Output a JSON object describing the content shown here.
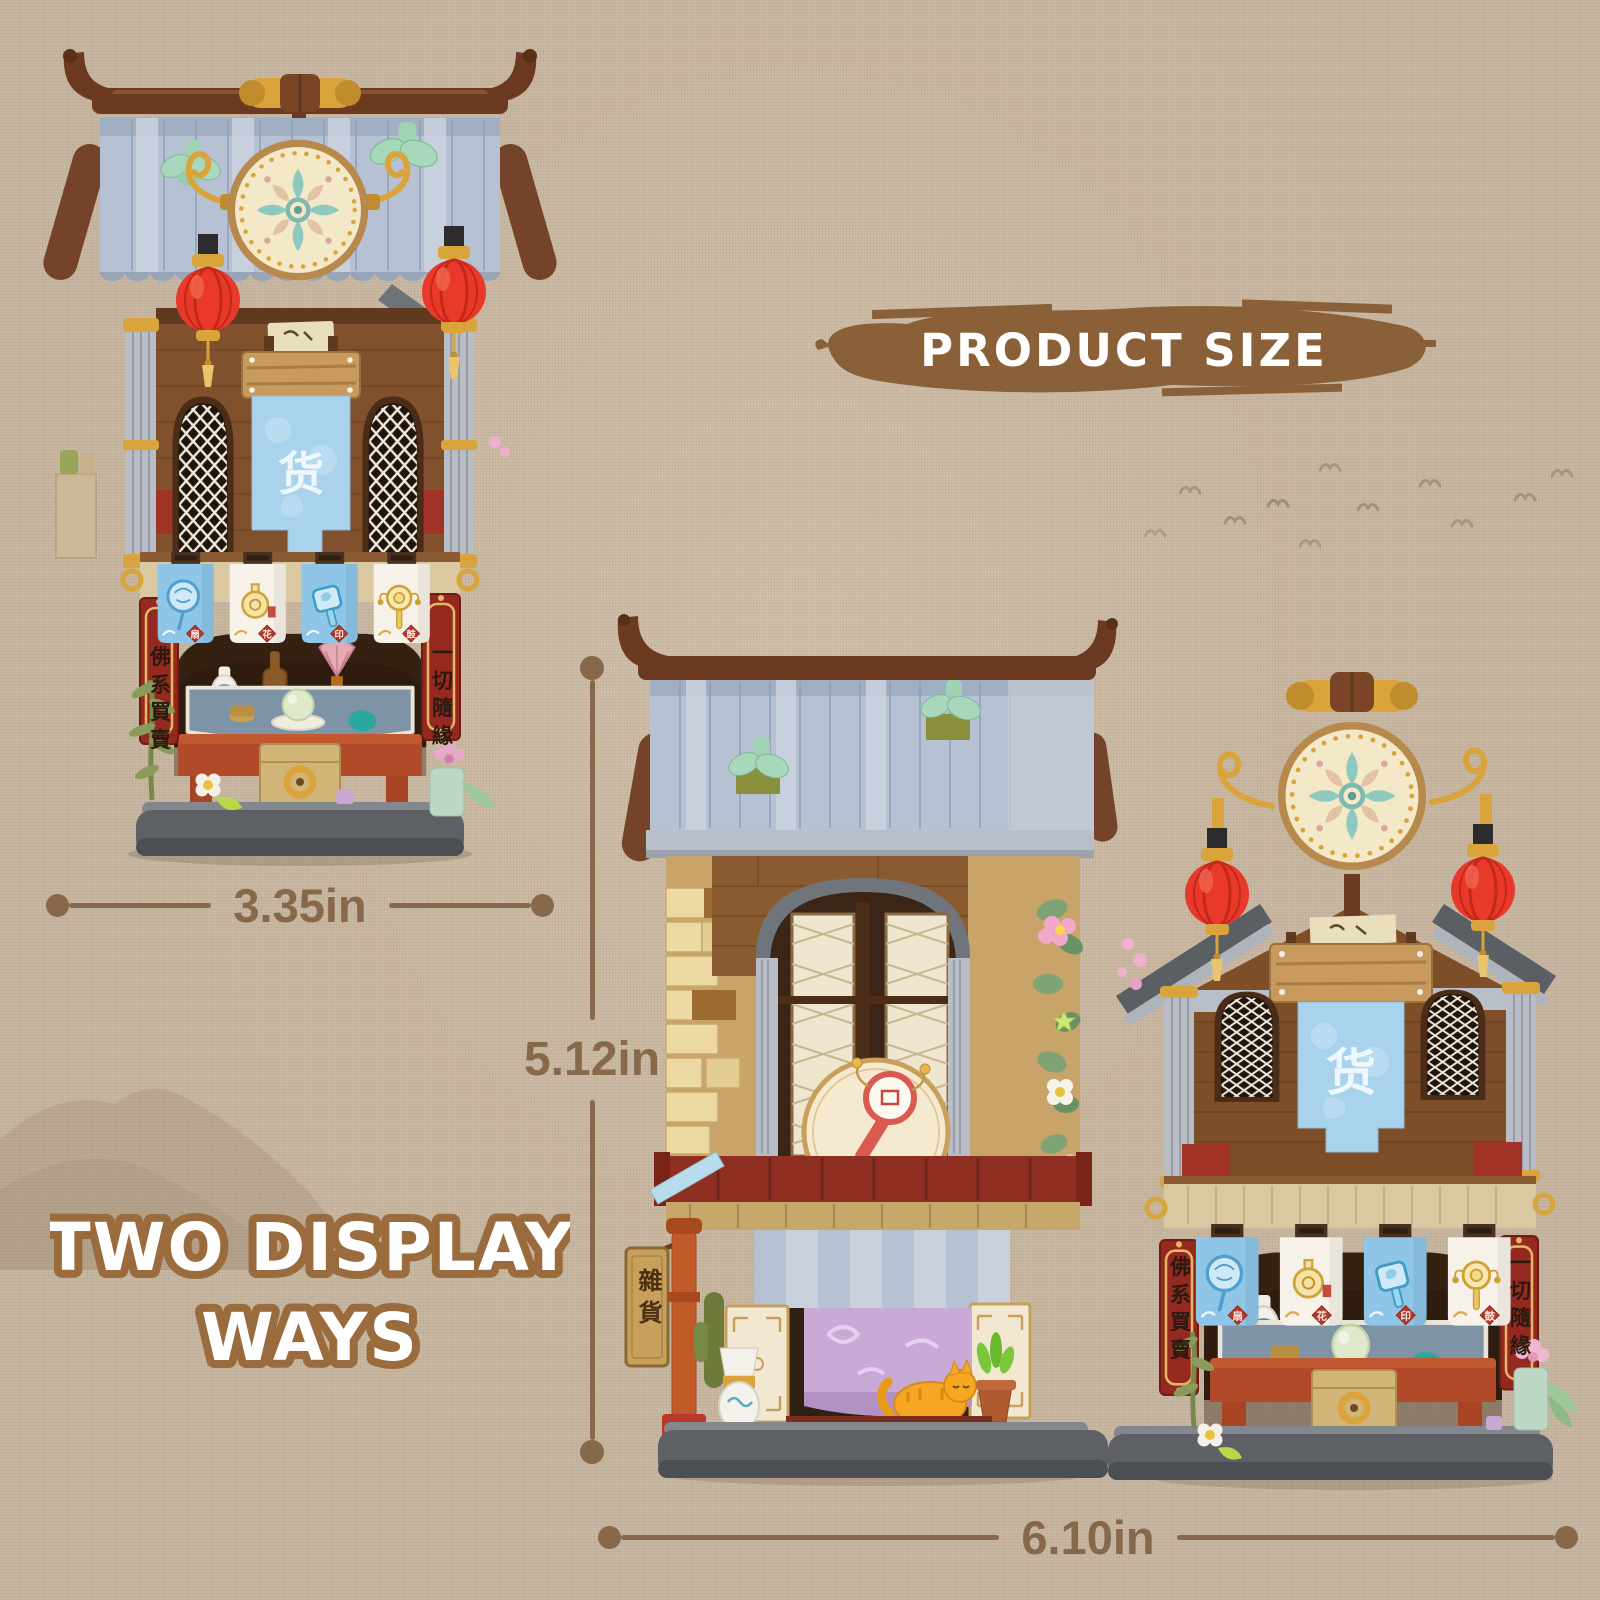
{
  "canvas": {
    "background": "#c8b7a2",
    "texture": "linen-weave"
  },
  "header": {
    "label": "PRODUCT SIZE",
    "brush_color": "#8a6038",
    "text_color": "#ffffff"
  },
  "dimensions": {
    "color": "#87684a",
    "single_width_label": "3.35in",
    "pair_height_label": "5.12in",
    "pair_width_label": "6.10in"
  },
  "display_ways": {
    "line1": "TWO DISPLAY",
    "line2": "WAYS",
    "fill": "#ffffff",
    "outline": "#9a6b3c"
  },
  "banner": {
    "char": "货",
    "color": "#a9d3ec"
  },
  "couplets": {
    "left": "佛系買賣",
    "right": "一切隨緣"
  },
  "flags": {
    "items": [
      {
        "icon": "round-fan-icon",
        "seal": "扇",
        "color": "#8fc6e8"
      },
      {
        "icon": "gourd-vase-icon",
        "seal": "花",
        "color": "#f6f2e9"
      },
      {
        "icon": "hand-mirror-icon",
        "seal": "印",
        "color": "#8fc6e8"
      },
      {
        "icon": "rattle-drum-icon",
        "seal": "鼓",
        "color": "#f6f2e9"
      }
    ]
  },
  "single_product": {
    "description": "Chinese street shop building-block set shown folded as a vertical two-storey stall"
  },
  "pair_product": {
    "description": "Same building-block set opened into two shops standing side by side",
    "left_shop_sign": "雜貨"
  },
  "palette": {
    "roof_tile_blue": "#b6c2d4",
    "beam_brown": "#6b3a20",
    "wall_brown": "#80512c",
    "wall_tan": "#d9c8a0",
    "lantern_red": "#e8392b",
    "gold": "#d9a43c",
    "flag_blue": "#8fc6e8",
    "flag_white": "#f6f2e9",
    "couplet_red": "#96291f",
    "counter_red": "#b04a28",
    "curtain_purple": "#c9aad6",
    "base_gray": "#5d6166"
  }
}
